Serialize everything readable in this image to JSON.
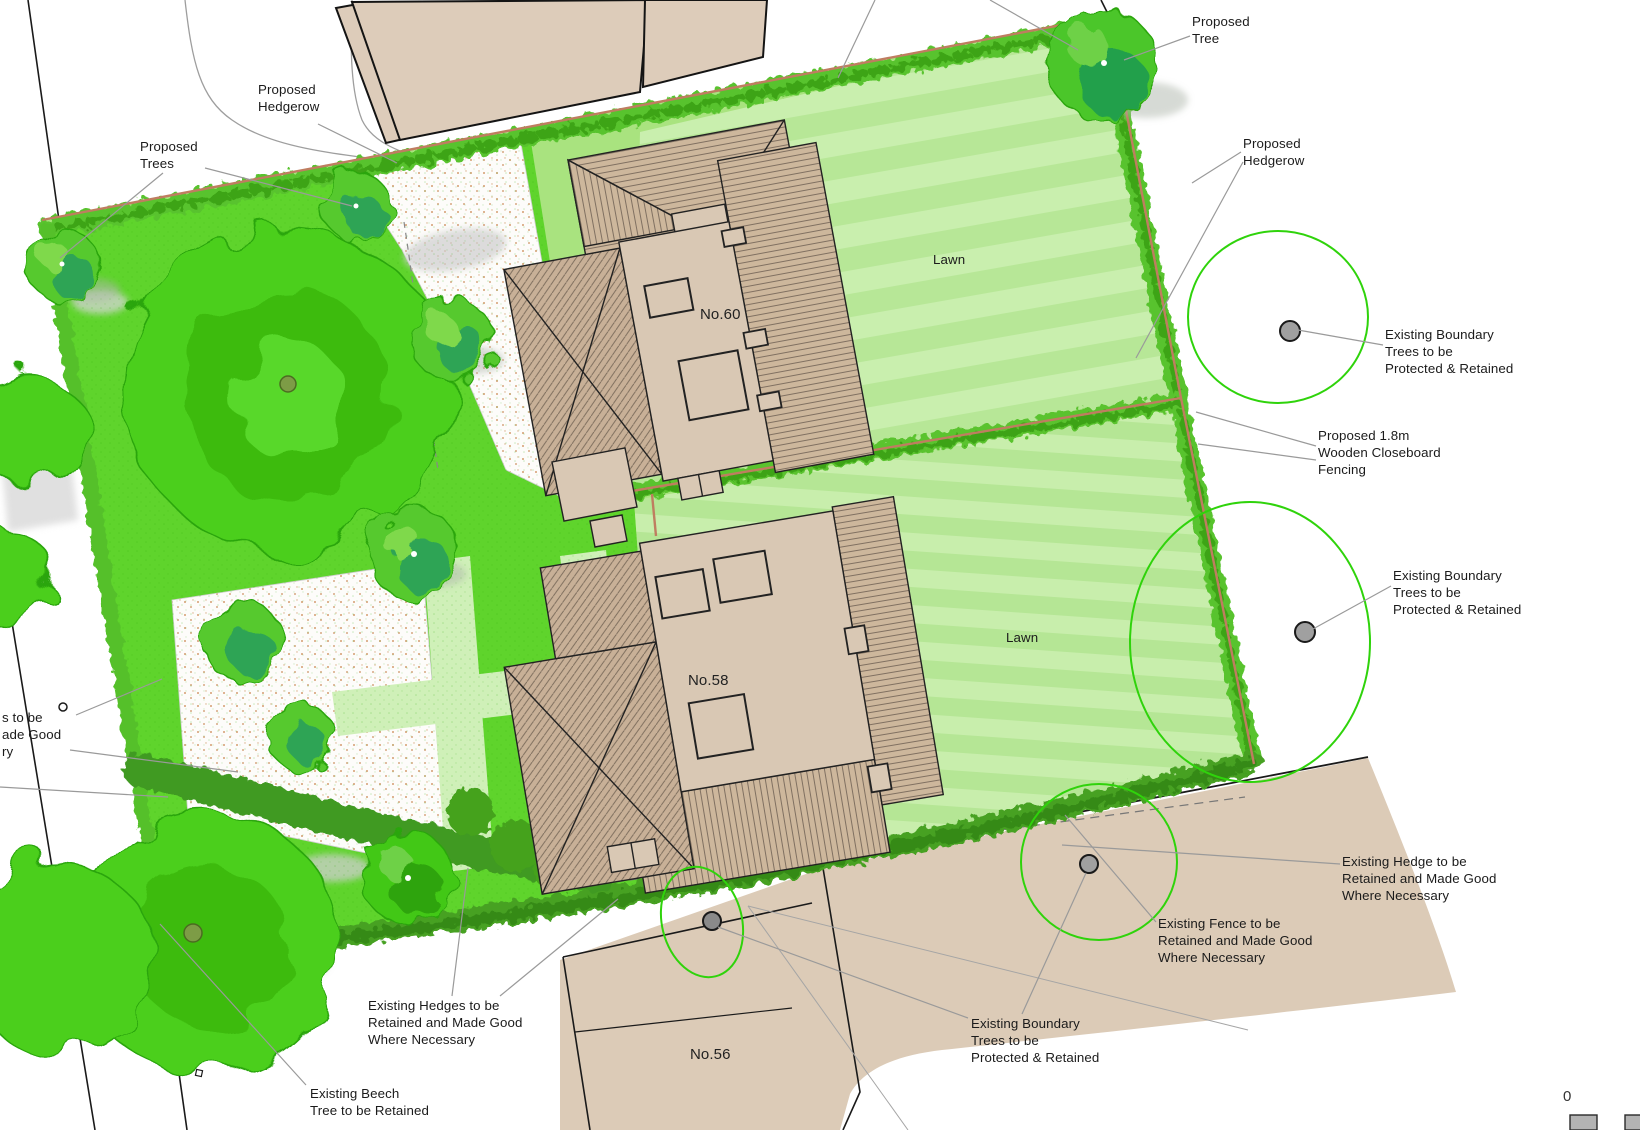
{
  "plan": {
    "labels": {
      "proposed_tree": "Proposed\nTree",
      "proposed_hedgerow_top": "Proposed\nHedgerow",
      "proposed_trees": "Proposed\nTrees",
      "proposed_hedgerow_right": "Proposed\nHedgerow",
      "lawn_60": "Lawn",
      "lawn_58": "Lawn",
      "existing_boundary_trees_1": "Existing Boundary\nTrees to be\nProtected & Retained",
      "proposed_fencing": "Proposed 1.8m\nWooden Closeboard\nFencing",
      "existing_boundary_trees_2": "Existing Boundary\nTrees to be\nProtected & Retained",
      "existing_boundary_trees_3": "Existing Boundary\nTrees to be\nProtected & Retained",
      "existing_hedge_bottom_right": "Existing Hedge to be\nRetained and Made Good\nWhere Necessary",
      "existing_fence": "Existing Fence to be\nRetained and Made Good\nWhere Necessary",
      "existing_hedges_bottom_left": "Existing Hedges to be\nRetained and Made Good\nWhere Necessary",
      "existing_beech": "Existing Beech\nTree to be Retained",
      "left_edge_clipped": "s to be\nade Good\nry",
      "house_60": "No.60",
      "house_58": "No.58",
      "house_56": "No.56",
      "scale_zero": "0"
    },
    "colors": {
      "lawn_stripe_light": "#c9efae",
      "lawn_stripe_dark": "#b7e797",
      "garden_grass": "#5fd42c",
      "hedge_green": "#58c32d",
      "hedge_dark": "#3f9a20",
      "tree_canopy": "#4ccf1d",
      "boundary_line_red": "#bf7d60",
      "protection_circle_green": "#2fd30b",
      "building_fill": "#ddccba",
      "house_fill": "#d9c8b4",
      "gravel_dot": "#c9854f",
      "tree_marker_gray": "#a0a0a0"
    }
  }
}
